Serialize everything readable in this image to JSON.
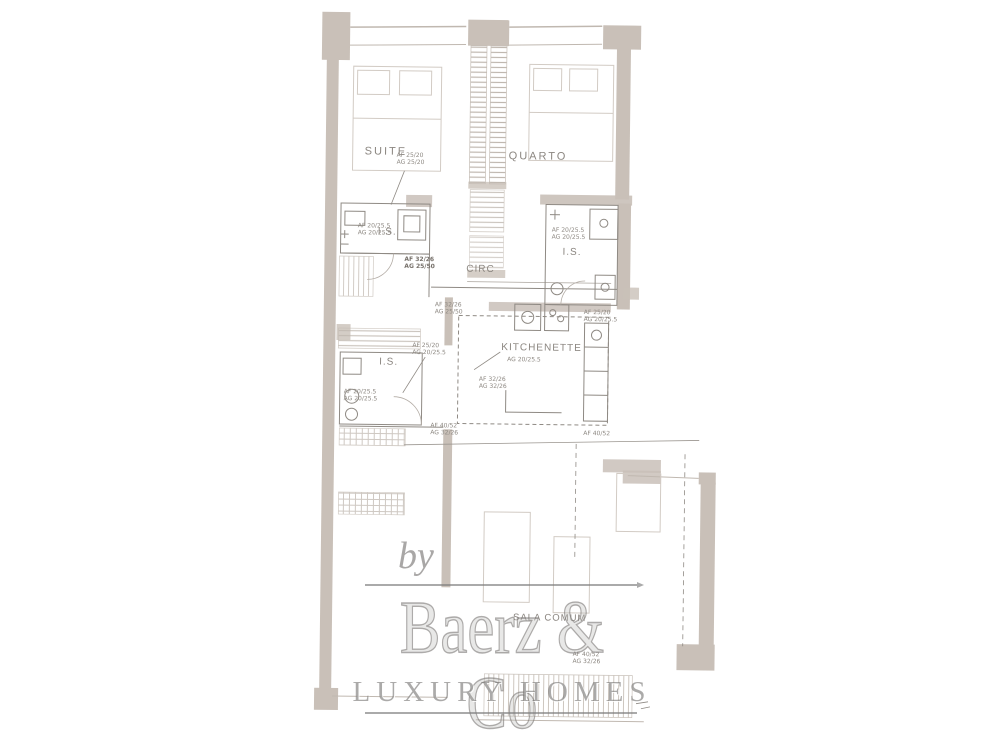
{
  "document": {
    "type": "floor-plan-scan"
  },
  "watermark": {
    "by": "by",
    "brand": "Baerz & Co",
    "tagline": "LUXURY HOMES"
  },
  "rooms": {
    "suite": "SUITE",
    "quarto": "QUARTO",
    "circ": "CIRC",
    "is1": "I.S.",
    "is2": "I.S.",
    "is3": "I.S.",
    "kitchenette": "KITCHENETTE",
    "sala": "SALA COMUM"
  },
  "annotations": {
    "suiteWindow": {
      "l1": "AF 25/20",
      "l2": "AG 25/20"
    },
    "is1Window": {
      "l1": "AF 20/25.5",
      "l2": "AG 20/25.5"
    },
    "circDoor": {
      "l1": "AF 32/26",
      "l2": "AG 25/50"
    },
    "kitLeft": {
      "l1": "AF 32/26",
      "l2": "AG 25/50"
    },
    "is2Window": {
      "l1": "AF 20/25.5",
      "l2": "AG 20/25.5"
    },
    "kitRight": {
      "l1": "AF 25/20",
      "l2": "AG 20/25.5"
    },
    "is3Upper": {
      "l1": "AF 25/20",
      "l2": "AG 20/25.5"
    },
    "kitSub": {
      "l1": "AG 20/25.5"
    },
    "kitMid": {
      "l1": "AF 32/26",
      "l2": "AG 32/26"
    },
    "is3Lower": {
      "l1": "AF 20/25.5",
      "l2": "AG 20/25.5"
    },
    "salaLeft": {
      "l1": "AF 40/52",
      "l2": "AG 32/26"
    },
    "salaRight": {
      "l1": "AF 40/52"
    },
    "salaBottom": {
      "l1": "AF 40/52",
      "l2": "AG 32/26"
    }
  },
  "colors": {
    "wall": "#c9c0b8",
    "ink": "#8f8a84",
    "faint": "#d2cbc4",
    "label": "#8b8680",
    "watermark": "#8f8d8b"
  }
}
